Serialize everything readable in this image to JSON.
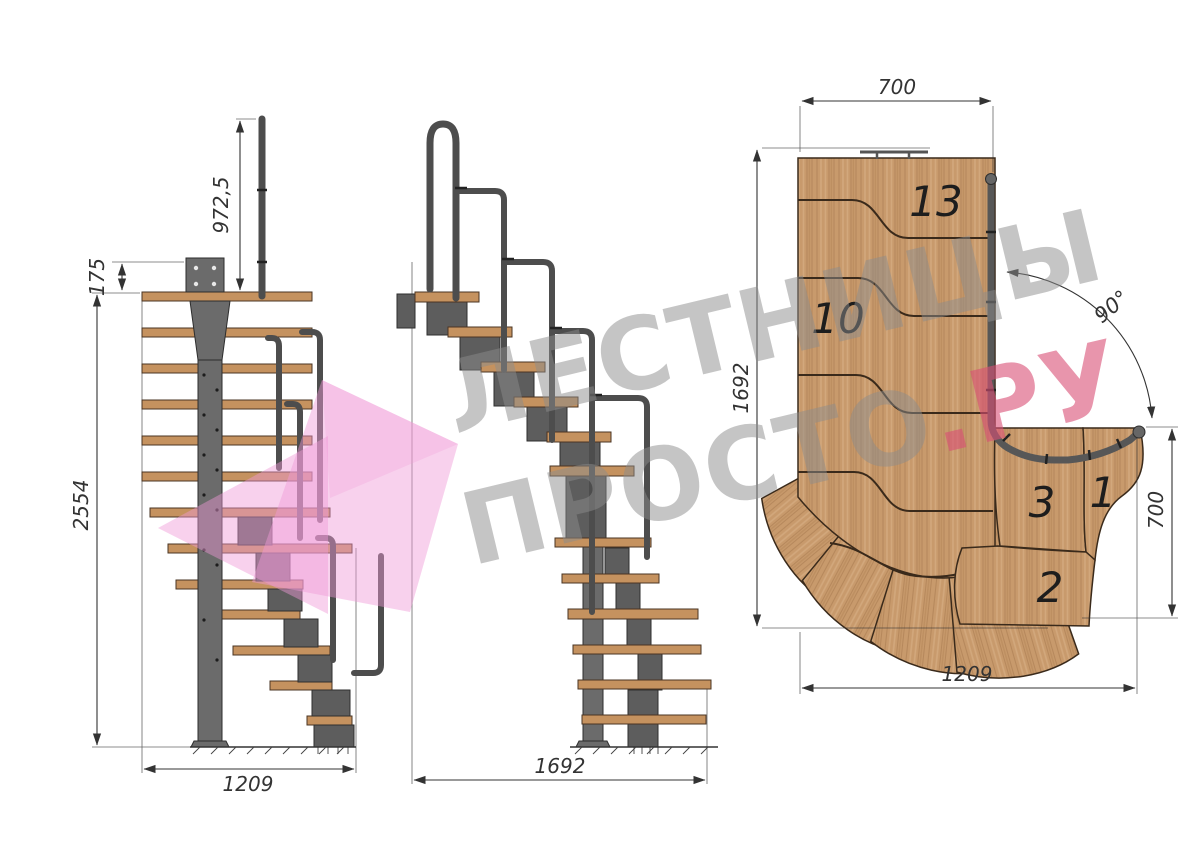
{
  "title": "Modular staircase technical drawing with 90° turn",
  "watermark": {
    "line1": "ЛЕСТНИЦЫ",
    "line2_main": "ПРОСТО",
    "line2_suffix": ".РУ"
  },
  "front_view": {
    "dim_rail_height": "972,5",
    "dim_bracket_offset": "175",
    "dim_total_height": "2554",
    "dim_width": "1209"
  },
  "side_view": {
    "dim_length": "1692"
  },
  "plan_view": {
    "dim_top_width": "700",
    "dim_left_length": "1692",
    "dim_right_width": "700",
    "dim_bottom_length": "1209",
    "dim_turn_angle": "90°",
    "step_labels": {
      "s13": "13",
      "s10": "10",
      "s3": "3",
      "s1": "1",
      "s2": "2"
    }
  },
  "colors": {
    "wood": "#c89a6c",
    "wood_grain_dark": "#a87a4e",
    "wood_grain_light": "#d9b187",
    "tread_side": "#c5925f",
    "metal": "#6b6b6b",
    "metal_dark": "#2e2e2e",
    "rail": "#4d4d4d",
    "dimension": "#333333",
    "watermark_gray": "#8c8c8c",
    "watermark_pink": "#d94f75",
    "logo_pink": "#f09ad6"
  }
}
